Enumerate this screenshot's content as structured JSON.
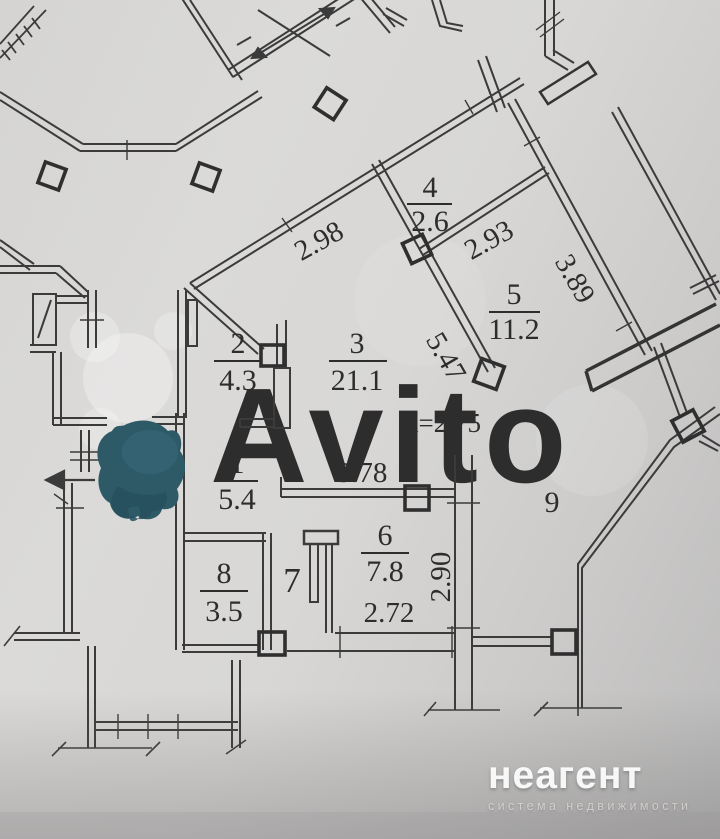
{
  "watermark": {
    "brand": "Avito"
  },
  "footer": {
    "brand": "неагент",
    "tagline": "система недвижимости"
  },
  "plan": {
    "ceiling_height": "h=2.75",
    "rooms": [
      {
        "num": "1",
        "area": "5.4"
      },
      {
        "num": "2",
        "area": "4.3"
      },
      {
        "num": "3",
        "area": "21.1"
      },
      {
        "num": "4",
        "area": "2.6"
      },
      {
        "num": "5",
        "area": "11.2"
      },
      {
        "num": "6",
        "area": "7.8"
      },
      {
        "num": "7",
        "area": ""
      },
      {
        "num": "8",
        "area": "3.5"
      },
      {
        "num": "9",
        "area": ""
      }
    ],
    "dims": {
      "d298": "2.98",
      "d293": "2.93",
      "d389": "3.89",
      "d547": "5.47",
      "d378": "3.78",
      "d290": "2.90",
      "d272": "2.72"
    }
  }
}
